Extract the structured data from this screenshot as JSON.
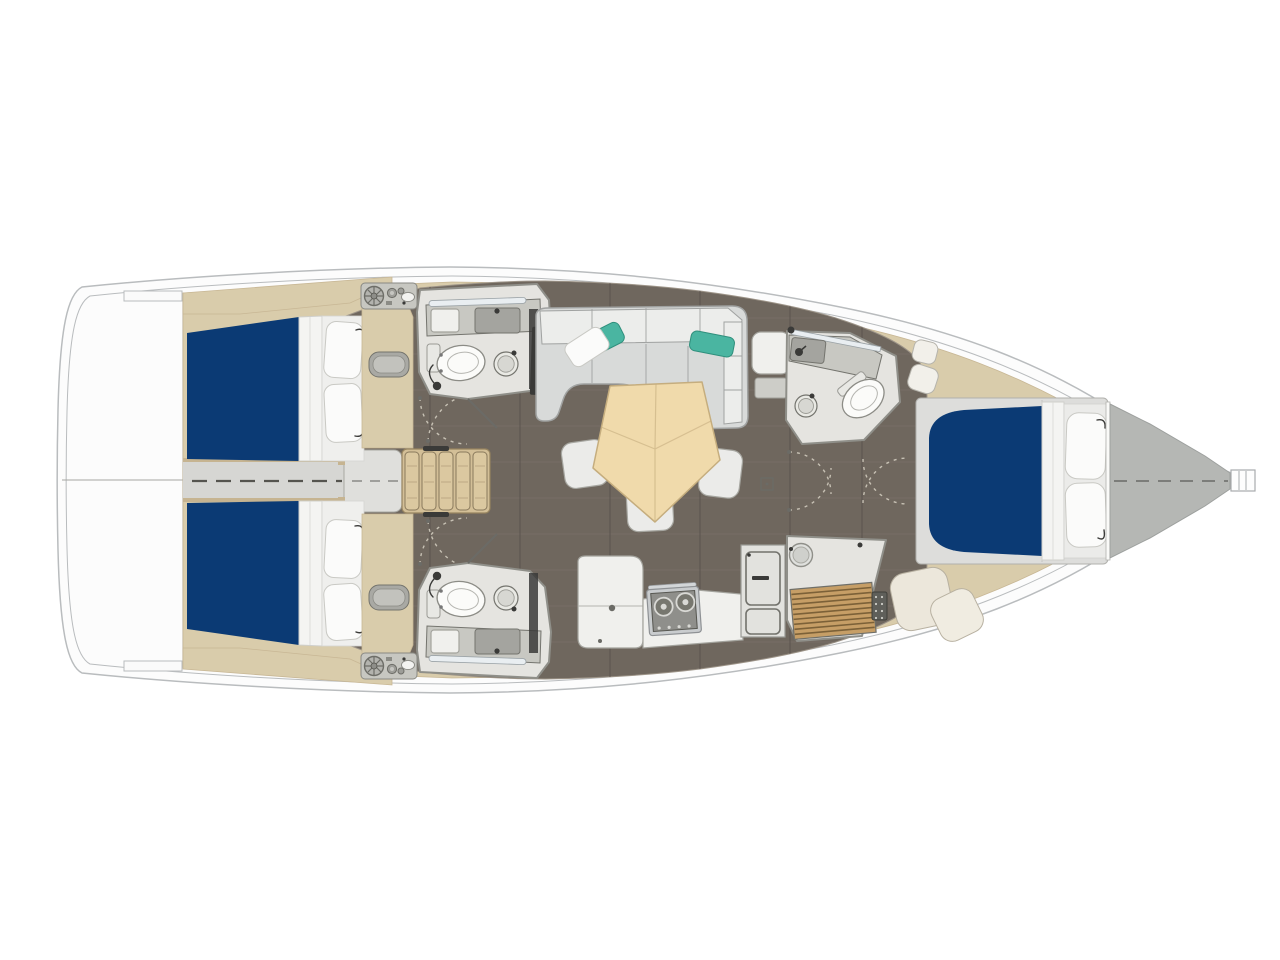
{
  "page": {
    "background": "#ffffff",
    "view": "Sailboat interior layout plan, overhead view, bow facing right"
  },
  "palette": {
    "page_bg": "#ffffff",
    "hull_fill": "#fcfcfc",
    "hull_line": "#b9bcbe",
    "deck_beige": "#d9ccab",
    "deck_beige_dark": "#c6b491",
    "floor_wood": "#6f675e",
    "plank_light": "#7d756b",
    "plank_dark": "#58514b",
    "bath_floor": "#e5e4e0",
    "wall": "#8f8f89",
    "wall_dark": "#74746e",
    "counter": "#c8c8c2",
    "sink_gray": "#a4a49f",
    "furn_white": "#f0f0ed",
    "furn_stroke": "#a3a39d",
    "bed_blue": "#0b3a74",
    "mattress": "#f4f4f2",
    "pillow": "#fbfbfa",
    "pillow_teal": "#4ab5a1",
    "sofa_seat": "#d8dad9",
    "sofa_back": "#ecedeb",
    "sofa_line": "#a0a2a1",
    "table_beige": "#f0daab",
    "table_edge": "#c5ad7e",
    "stool": "#ebebe9",
    "stair_wood": "#d3bf97",
    "stair_edge": "#96835f",
    "dark": "#3a3a38",
    "teak": "#c69e66",
    "teak_line": "#7c6138",
    "forepeak": "#b5b7b4",
    "walkway": "#d6d6d3",
    "arc": "#c7c1b4",
    "dash": "#55544f"
  },
  "boat": {
    "orientation": "bow-right",
    "rooms": [
      {
        "id": "aft-cabin-port",
        "name": "Aft cabin port: double berth with navy mattress and two pillows"
      },
      {
        "id": "aft-cabin-starboard",
        "name": "Aft cabin starboard: double berth with navy mattress and two pillows"
      },
      {
        "id": "aft-head-port",
        "name": "Aft head port: toilet, sink, shower"
      },
      {
        "id": "aft-head-starboard",
        "name": "Aft head starboard: toilet, sink, shower"
      },
      {
        "id": "companionway",
        "name": "Companionway: five wooden steps with landing"
      },
      {
        "id": "salon",
        "name": "Salon: L-shaped sofa with teal pillows, pentagon table, three stools"
      },
      {
        "id": "galley",
        "name": "Galley: two-burner stove, counters, fridge cabinet"
      },
      {
        "id": "forward-head",
        "name": "Forward head: toilet and sink"
      },
      {
        "id": "forward-shower",
        "name": "Forward shower: teak grate floor and porthole"
      },
      {
        "id": "forward-cabin",
        "name": "Forward cabin: island double berth with two pillows"
      },
      {
        "id": "forepeak",
        "name": "Forepeak locker"
      },
      {
        "id": "transom",
        "name": "Transom and stern platform"
      }
    ],
    "counts": {
      "berths": 3,
      "toilets": 3,
      "shower_rooms": 1,
      "stools": 3,
      "stair_steps": 5,
      "stove_burners": 2,
      "teal_pillows": 2
    }
  }
}
